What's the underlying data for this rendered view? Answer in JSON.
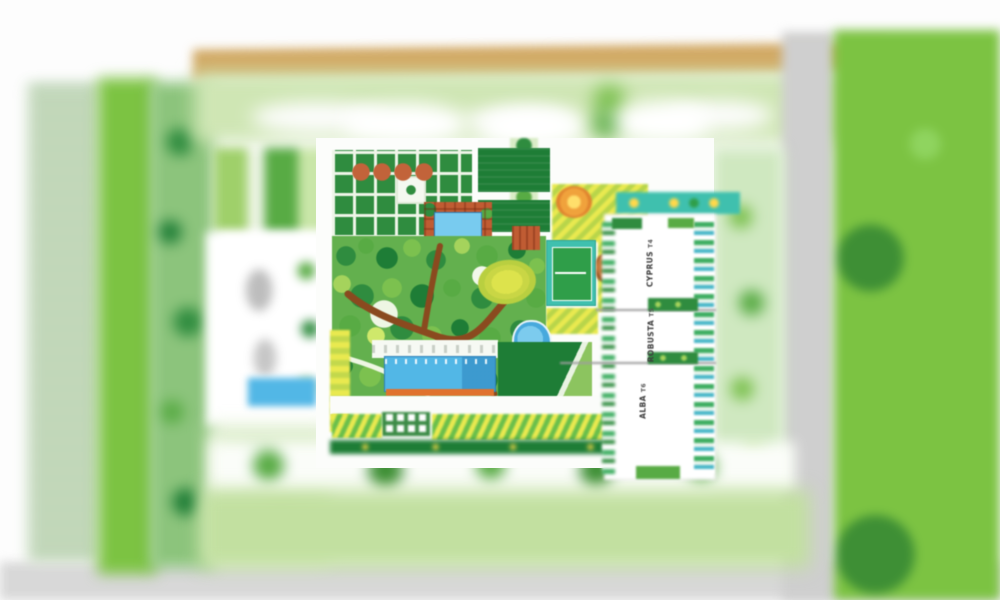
{
  "plan": {
    "title": "residential masterplan site layout",
    "towers": [
      {
        "name": "CYPRUS",
        "code": "T4"
      },
      {
        "name": "ROBUSTA",
        "code": "T5"
      },
      {
        "name": "ALBA",
        "code": "T6"
      }
    ],
    "features": [
      "main-swimming-pool",
      "lap-pool",
      "kids-pond",
      "tennis-court",
      "formal-hedge-garden",
      "central-woodland-garden",
      "yellow-event-lawn",
      "pergola-deck",
      "perimeter-road",
      "parking-strip",
      "green-field"
    ]
  },
  "palette": {
    "field-green": "#7cc342",
    "lawn-dark": "#1e7d36",
    "band-lightgreen": "#cfe6b4",
    "pool-blue": "#52b7e6",
    "deck-terracotta": "#c05c33",
    "deck-orange": "#e0722e",
    "court-teal": "#3fc0ae",
    "court-green": "#2f9e49",
    "stripe-yellow": "#e9e94f",
    "oval-yellow": "#dde34c",
    "road-tan": "#d2a964",
    "road-gray": "#cfcfcf",
    "path-brown": "#8a4a1f",
    "bottom-gray": "#d8d8d8"
  }
}
